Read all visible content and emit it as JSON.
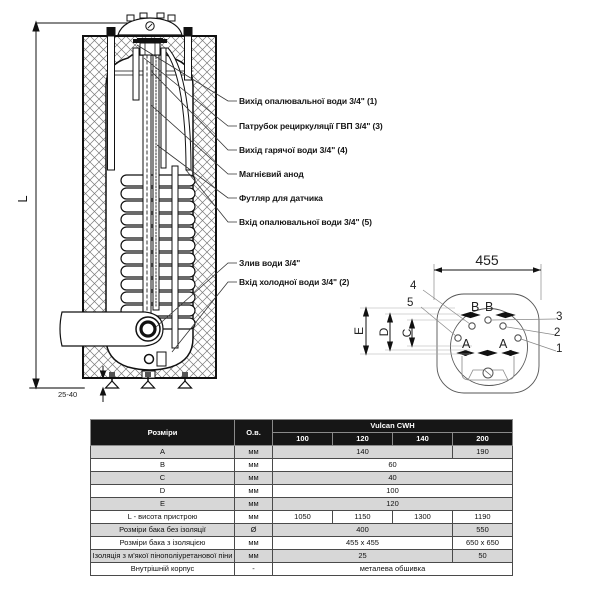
{
  "callouts": [
    "Вихід опалювальної води 3/4\" (1)",
    "Патрубок рециркуляції ГВП 3/4\" (3)",
    "Вихід гарячої води 3/4\" (4)",
    "Магнієвий анод",
    "Футляр для датчика",
    "Вхід опалювальної води 3/4\" (5)",
    "Злив води 3/4\"",
    "Вхід холодної води 3/4\" (2)"
  ],
  "dimensions": {
    "height_label": "L",
    "foot_clearance": "25-40",
    "top_width": "455",
    "letters": {
      "a": "A",
      "b": "B",
      "c": "C",
      "d": "D",
      "e": "E"
    },
    "ports": {
      "n1": "1",
      "n2": "2",
      "n3": "3",
      "n4": "4",
      "n5": "5"
    }
  },
  "table": {
    "title": "Розміри",
    "unit_col": "О.в.",
    "series": "Vulcan CWH",
    "models": [
      "100",
      "120",
      "140",
      "200"
    ],
    "rows": [
      {
        "label": "A",
        "unit": "мм",
        "main": "140",
        "last": "190"
      },
      {
        "label": "B",
        "unit": "мм",
        "all": "60"
      },
      {
        "label": "C",
        "unit": "мм",
        "all": "40"
      },
      {
        "label": "D",
        "unit": "мм",
        "all": "100"
      },
      {
        "label": "E",
        "unit": "мм",
        "all": "120"
      },
      {
        "label": "L - висота пристрою",
        "unit": "мм",
        "c100": "1050",
        "c120": "1150",
        "c140": "1300",
        "c200": "1190"
      },
      {
        "label": "Розміри бака без ізоляції",
        "unit": "Ø",
        "main": "400",
        "last": "550"
      },
      {
        "label": "Розміри бака з ізоляцією",
        "unit": "мм",
        "main": "455 x 455",
        "last": "650 x 650"
      },
      {
        "label": "Ізоляція з м'якої пінополіуретанової піни",
        "unit": "мм",
        "main": "25",
        "last": "50"
      },
      {
        "label": "Внутрішній корпус",
        "unit": "-",
        "all": "металева обшивка"
      }
    ]
  }
}
